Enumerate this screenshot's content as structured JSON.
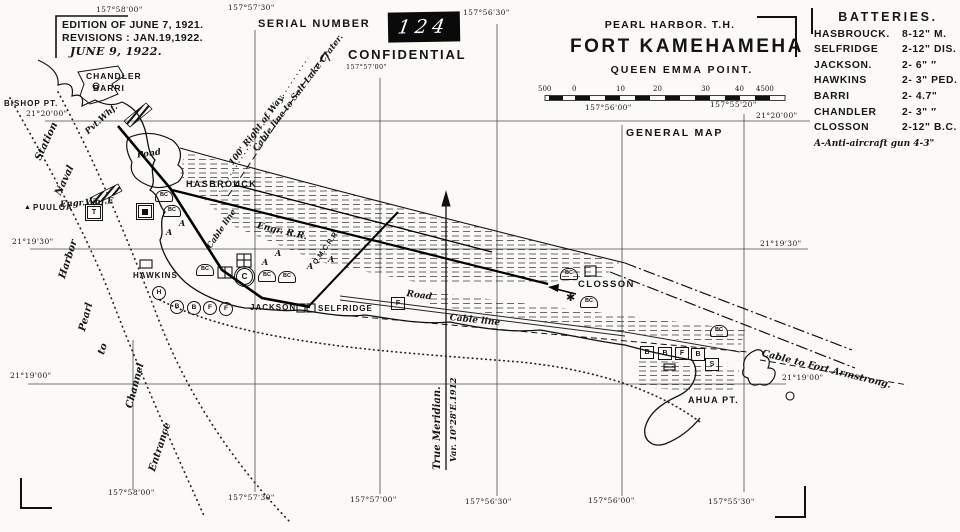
{
  "edition": {
    "line1": "EDITION OF JUNE 7, 1921.",
    "line2": "REVISIONS : JAN.19,1922.",
    "line3": "JUNE 9, 1922."
  },
  "serial": {
    "label": "SERIAL NUMBER",
    "number": "124"
  },
  "confidential": "CONFIDENTIAL",
  "title": {
    "region": "PEARL HARBOR. T.H.",
    "name": "FORT KAMEHAMEHA",
    "subtitle": "QUEEN EMMA POINT.",
    "map_type": "GENERAL MAP"
  },
  "scale_bar": {
    "ticks": [
      "500",
      "0",
      "10",
      "20",
      "30",
      "40",
      "4500"
    ]
  },
  "batteries": {
    "title": "BATTERIES.",
    "rows": [
      {
        "name": "HASBROUCK.",
        "armament": "8-12\" M."
      },
      {
        "name": "SELFRIDGE",
        "armament": "2-12\" DIS."
      },
      {
        "name": "JACKSON.",
        "armament": "2- 6\"  ″"
      },
      {
        "name": "HAWKINS",
        "armament": "2- 3\" PED."
      },
      {
        "name": "BARRI",
        "armament": "2- 4.7\""
      },
      {
        "name": "CHANDLER",
        "armament": "2- 3\"  ″"
      },
      {
        "name": "CLOSSON",
        "armament": "2-12\" B.C."
      }
    ],
    "note": "A-Anti-aircraft gun 4-3\""
  },
  "coordinates": {
    "top_1": "157°58'00\"",
    "top_2": "157°57'30\"",
    "top_3": "157°56'30\"",
    "top_small": "157°57'00\"",
    "scale_left": "157°56'00\"",
    "scale_right": "157°55'20\"",
    "bottom_1": "157°58'00\"",
    "bottom_2": "157°57'30\"",
    "bottom_3": "157°57'00\"",
    "bottom_4": "157°56'30\"",
    "bottom_5": "157°56'00\"",
    "bottom_6": "157°55'30\"",
    "lat_left_1": "21°20'00\"",
    "lat_left_2": "21°19'30\"",
    "lat_left_3": "21°19'00\"",
    "lat_right_1": "21°20'00\"",
    "lat_right_2": "21°19'30\"",
    "lat_right_3": "21°19'00\""
  },
  "features": {
    "chandler": "CHANDLER",
    "barri": "BARRI",
    "bishop": "BISHOP PT.",
    "pvt_whf": "Pvt.Whf.",
    "pond": "Pond",
    "hasbrouck": "HASBROUCK",
    "engr_whf": "Engr.Whf.E",
    "puuloa": "PUULOA",
    "hawkins": "HAWKINS",
    "jackson": "JACKSON",
    "selfridge": "SELFRIDGE",
    "closson": "CLOSSON",
    "ahua": "AHUA PT.",
    "engr_rr": "Engr. R.R.",
    "qmc_rr": "Q.M.C.R.R.",
    "road": "Road",
    "cable_line": "Cable line",
    "cable_line2": "Cable line",
    "right_of_way": "100' Right of Way.",
    "salt_lake": "Cable line to Salt Lake Crater.",
    "armstrong": "Cable to Fort Armstrong.",
    "meridian": "True Meridian.",
    "meridian_var": "Var. 10°28'E.1912",
    "ch_station": "Station",
    "ch_naval": "Naval",
    "ch_harbor": "Harbor",
    "ch_pearl": "Pearl",
    "ch_to": "to",
    "ch_channel": "Channel",
    "ch_entrance": "Entrance"
  },
  "symbols": {
    "a": "A",
    "b": "B",
    "f": "F",
    "h": "H",
    "c": "C",
    "s": "S",
    "t": "T",
    "bc": "BC",
    "star": "✱",
    "triangle": "▲"
  }
}
